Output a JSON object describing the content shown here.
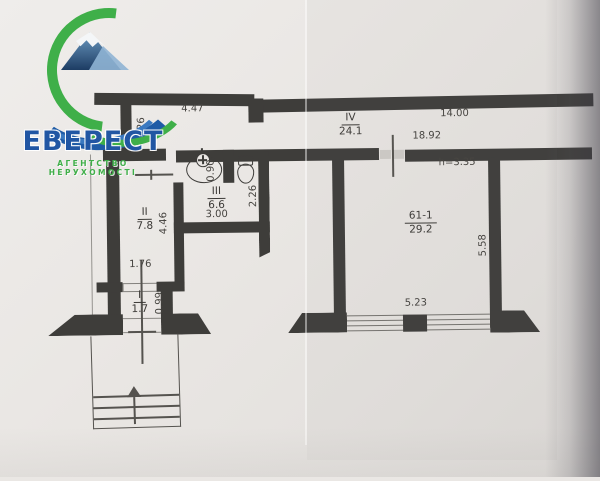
{
  "logo": {
    "title": "ЕВЕРЕСТ",
    "subtitle": "АГЕНТСТВО НЕРУХОМОСТІ"
  },
  "rooms": {
    "hallway": {
      "num": "IV",
      "area": "24.1"
    },
    "bathroom": {
      "num": "III",
      "area": "6.6"
    },
    "room2": {
      "num": "II",
      "area": "7.8"
    },
    "vestibule": {
      "num": "I",
      "area": "1.7"
    },
    "main": {
      "num": "61-1",
      "area": "29.2"
    }
  },
  "dims": {
    "top_left": "4.47",
    "top_left_side": "1.26",
    "top_right": "14.00",
    "inner_wall": "18.92",
    "ceiling_height": "h=3.35",
    "sink_recess": "0.90",
    "bath_depth": "2.26",
    "bath_width": "3.00",
    "room2_depth": "4.46",
    "entry_opening": "1.76",
    "vestibule_depth": "0.99",
    "main_depth": "5.58",
    "window_width": "5.23"
  },
  "colors": {
    "wall": "#3e3d3a",
    "paper": "#eae7e4",
    "logo_blue": "#2156a3",
    "logo_green": "#3faf49"
  }
}
